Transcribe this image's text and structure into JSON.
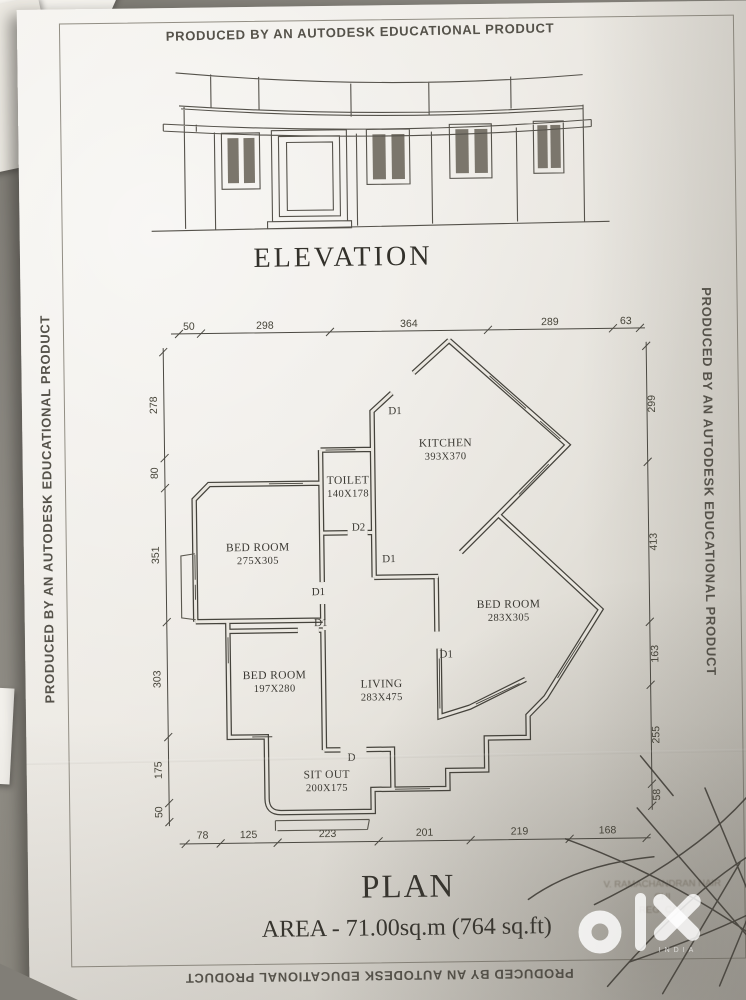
{
  "photo": {
    "backdrop_color": "#8d8a83",
    "paper_color": "#ece9e3",
    "ink_color": "#3b3933",
    "pen_color": "#35322c",
    "watermark_color": "#ffffff"
  },
  "border_text": {
    "top": "PRODUCED BY AN AUTODESK EDUCATIONAL PRODUCT",
    "left": "PRODUCED BY AN AUTODESK EDUCATIONAL PRODUCT",
    "right": "PRODUCED BY AN AUTODESK EDUCATIONAL PRODUCT",
    "bottom": "PRODUCED BY AN AUTODESK EDUCATIONAL PRODUCT"
  },
  "elevation": {
    "title": "ELEVATION"
  },
  "plan": {
    "title": "PLAN",
    "area_line": "AREA - 71.00sq.m (764 sq.ft)",
    "rooms": [
      {
        "name": "KITCHEN",
        "size": "393X370"
      },
      {
        "name": "TOILET",
        "size": "140X178"
      },
      {
        "name": "BED ROOM",
        "size": "275X305"
      },
      {
        "name": "BED ROOM",
        "size": "283X305"
      },
      {
        "name": "BED ROOM",
        "size": "197X280"
      },
      {
        "name": "LIVING",
        "size": "283X475"
      },
      {
        "name": "SIT OUT",
        "size": "200X175"
      }
    ],
    "door_labels": [
      "D1",
      "D2",
      "D1",
      "D1",
      "D1",
      "D1",
      "D"
    ],
    "dims": {
      "top": [
        "50",
        "298",
        "364",
        "289",
        "63"
      ],
      "left": [
        "278",
        "80",
        "351",
        "303",
        "175",
        "50"
      ],
      "right": [
        "299",
        "413",
        "163",
        "255",
        "58"
      ],
      "bottom": [
        "78",
        "125",
        "223",
        "201",
        "219",
        "168"
      ]
    }
  },
  "stamp": {
    "line1": "V. RAMACHANDRAN NAIR",
    "line2": "CHI",
    "line3": "REG. CA/7"
  },
  "watermark": {
    "brand": "olx",
    "country": "INDIA"
  }
}
